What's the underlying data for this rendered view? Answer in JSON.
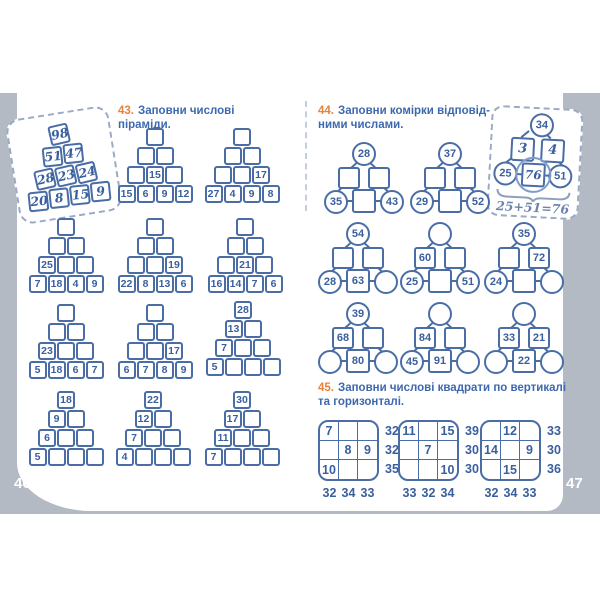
{
  "page": {
    "left_number": "46",
    "right_number": "47"
  },
  "colors": {
    "accent_blue": "#4a6da6",
    "accent_orange": "#e8813b",
    "backdrop_gray": "#b4bac3"
  },
  "ex43": {
    "number": "43.",
    "title": "Заповни числові піраміди.",
    "example": {
      "rows": [
        [
          "98"
        ],
        [
          "51",
          "47"
        ],
        [
          "28",
          "23",
          "24"
        ],
        [
          "20",
          "8",
          "15",
          "9"
        ]
      ]
    },
    "pyramids": [
      {
        "rows": [
          [
            null
          ],
          [
            null,
            null
          ],
          [
            null,
            "15",
            null
          ],
          [
            "15",
            "6",
            "9",
            "12"
          ]
        ]
      },
      {
        "rows": [
          [
            null
          ],
          [
            null,
            null
          ],
          [
            null,
            null,
            "17"
          ],
          [
            "27",
            "4",
            "9",
            "8"
          ]
        ]
      },
      {
        "rows": [
          [
            null
          ],
          [
            null,
            null
          ],
          [
            "25",
            null,
            null
          ],
          [
            "7",
            "18",
            "4",
            "9"
          ]
        ]
      },
      {
        "rows": [
          [
            null
          ],
          [
            null,
            null
          ],
          [
            null,
            null,
            "19"
          ],
          [
            "22",
            "8",
            "13",
            "6"
          ]
        ]
      },
      {
        "rows": [
          [
            null
          ],
          [
            null,
            null
          ],
          [
            null,
            "21",
            null
          ],
          [
            "16",
            "14",
            "7",
            "6"
          ]
        ]
      },
      {
        "rows": [
          [
            null
          ],
          [
            null,
            null
          ],
          [
            "23",
            null,
            null
          ],
          [
            "5",
            "18",
            "6",
            "7"
          ]
        ]
      },
      {
        "rows": [
          [
            null
          ],
          [
            null,
            null
          ],
          [
            null,
            null,
            "17"
          ],
          [
            "6",
            "7",
            "8",
            "9"
          ]
        ]
      },
      {
        "rows": [
          [
            "28"
          ],
          [
            "13",
            null
          ],
          [
            "7",
            null,
            null
          ],
          [
            "5",
            null,
            null,
            null
          ]
        ]
      },
      {
        "rows": [
          [
            "18"
          ],
          [
            "9",
            null
          ],
          [
            "6",
            null,
            null
          ],
          [
            "5",
            null,
            null,
            null
          ]
        ]
      },
      {
        "rows": [
          [
            "22"
          ],
          [
            "12",
            null
          ],
          [
            "7",
            null,
            null
          ],
          [
            "4",
            null,
            null,
            null
          ]
        ]
      },
      {
        "rows": [
          [
            "30"
          ],
          [
            "17",
            null
          ],
          [
            "11",
            null,
            null
          ],
          [
            "7",
            null,
            null,
            null
          ]
        ]
      }
    ]
  },
  "ex44": {
    "number": "44.",
    "title_line1": "Заповни комірки відповід-",
    "title_line2": "ними числами.",
    "example": {
      "top": "34",
      "squares": [
        "3",
        "4"
      ],
      "bottom": [
        "25",
        "76",
        "51"
      ],
      "caption": "25+51=76"
    },
    "diagrams": [
      {
        "top": "28",
        "squares": [
          null,
          null
        ],
        "bottom": [
          "35",
          null,
          "43"
        ]
      },
      {
        "top": "37",
        "squares": [
          null,
          null
        ],
        "bottom": [
          "29",
          null,
          "52"
        ]
      },
      {
        "top": "54",
        "squares": [
          null,
          null
        ],
        "bottom": [
          "28",
          "63",
          null
        ]
      },
      {
        "top": null,
        "squares": [
          "60",
          null
        ],
        "bottom": [
          "25",
          null,
          "51"
        ]
      },
      {
        "top": "35",
        "squares": [
          null,
          "72"
        ],
        "bottom": [
          "24",
          null,
          null
        ]
      },
      {
        "top": "39",
        "squares": [
          "68",
          null
        ],
        "bottom": [
          null,
          "80",
          null
        ]
      },
      {
        "top": null,
        "squares": [
          "84",
          null
        ],
        "bottom": [
          "45",
          "91",
          null
        ]
      },
      {
        "top": null,
        "squares": [
          "33",
          "21"
        ],
        "bottom": [
          null,
          "22",
          null
        ]
      }
    ]
  },
  "ex45": {
    "number": "45.",
    "title_line1": "Заповни числові квадрати по вертикалі",
    "title_line2": "та горизонталі.",
    "grids": [
      {
        "cells": [
          [
            "7",
            null,
            null
          ],
          [
            null,
            "8",
            "9"
          ],
          [
            "10",
            null,
            null
          ]
        ],
        "row_sums": [
          "32",
          "32",
          "35"
        ],
        "col_sums": [
          "32",
          "34",
          "33"
        ]
      },
      {
        "cells": [
          [
            "11",
            null,
            "15"
          ],
          [
            null,
            "7",
            null
          ],
          [
            null,
            null,
            "10"
          ]
        ],
        "row_sums": [
          "39",
          "30",
          "30"
        ],
        "col_sums": [
          "33",
          "32",
          "34"
        ]
      },
      {
        "cells": [
          [
            null,
            "12",
            null
          ],
          [
            "14",
            null,
            "9"
          ],
          [
            null,
            "15",
            null
          ]
        ],
        "row_sums": [
          "33",
          "30",
          "36"
        ],
        "col_sums": [
          "32",
          "34",
          "33"
        ]
      }
    ]
  }
}
